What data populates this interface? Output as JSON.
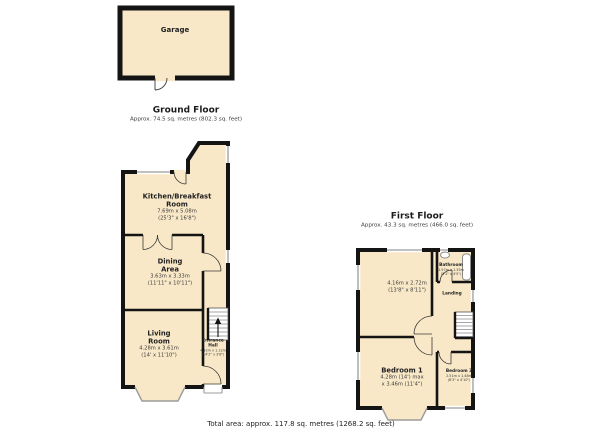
{
  "garage": {
    "name": "Garage"
  },
  "ground": {
    "title": "Ground Floor",
    "subtitle": "Approx. 74.5 sq. metres (802.3 sq. feet)",
    "kitchen": {
      "name": "Kitchen/Breakfast Room",
      "metric": "7.69m x 5.08m",
      "imperial": "(25'3\" x 16'8\")"
    },
    "dining": {
      "name": "Dining Area",
      "metric": "3.63m x 3.33m",
      "imperial": "(11'11\" x 10'11\")"
    },
    "living": {
      "name": "Living Room",
      "metric": "4.28m x 3.61m",
      "imperial": "(14' x 11'10\")"
    },
    "hall": {
      "name": "Entrance Hall",
      "metric": "4.32m x 1.12m",
      "imperial": "(14'2\" x 3'8\")"
    }
  },
  "first": {
    "title": "First Floor",
    "subtitle": "Approx. 43.3 sq. metres (466.0 sq. feet)",
    "bedroom2": {
      "metric": "4.16m x 2.72m",
      "imperial": "(13'8\" x 8'11\")"
    },
    "bathroom": {
      "name": "Bathroom",
      "metric": "1.57m x 1.35m",
      "imperial": "(5'2\" x 4'5\")"
    },
    "landing": {
      "name": "Landing"
    },
    "bedroom1": {
      "name": "Bedroom 1",
      "metric": "4.28m (14') max",
      "imperial": "x 3.46m (11'4\")"
    },
    "bedroom3": {
      "name": "Bedroom 3",
      "metric": "2.51m x 1.48m",
      "imperial": "(8'3\" x 4'10\")"
    }
  },
  "footer": {
    "total_area": "Total area: approx. 117.8 sq. metres (1268.2 sq. feet)"
  },
  "colors": {
    "room_fill": "#F8E8C7",
    "wall": "#141414",
    "window": "#9C9C9C"
  }
}
